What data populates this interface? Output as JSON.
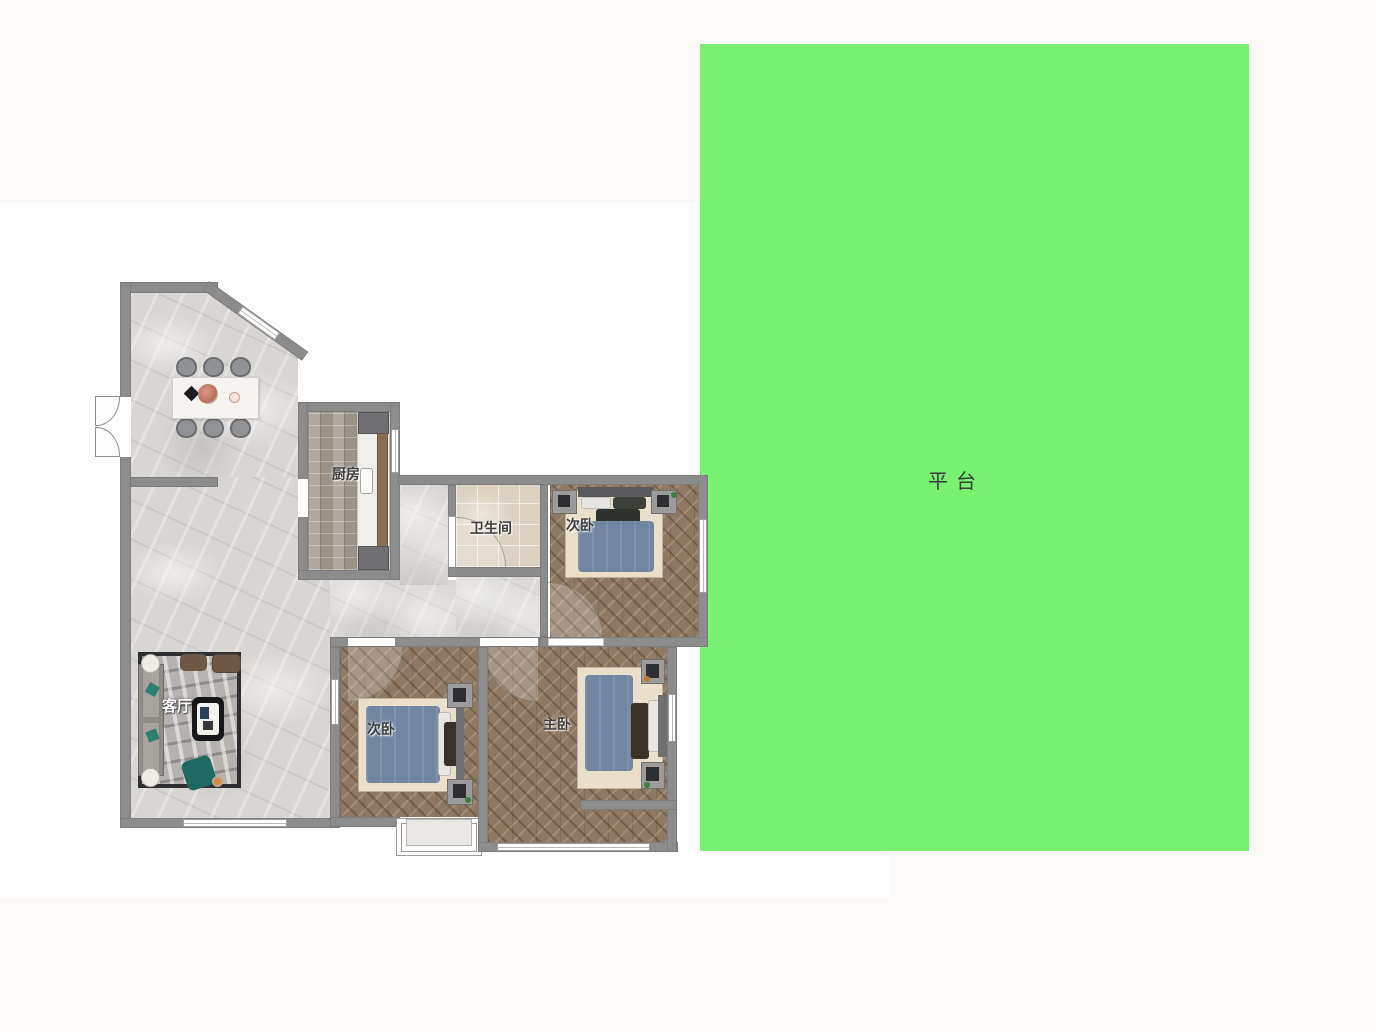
{
  "canvas": {
    "width": 1376,
    "height": 1032
  },
  "rooms": {
    "kitchen": {
      "label": "厨房"
    },
    "bathroom": {
      "label": "卫生间"
    },
    "bedroom_top": {
      "label": "次卧"
    },
    "bedroom_left": {
      "label": "次卧"
    },
    "bedroom_master": {
      "label": "主卧"
    },
    "living": {
      "label": "客厅"
    },
    "platform": {
      "label": "平台"
    }
  },
  "colors": {
    "platform_green": "#78f170",
    "wall_gray": "#8c8c8c",
    "marble_floor": "#d8d6d3",
    "wood_herringbone": "#8e7963",
    "kitchen_parquet": "#a89e94",
    "bath_tile": "#ddd2c1",
    "bed_duvet": "#7285a1",
    "bed_mat": "#e9dfca",
    "rug_gray": "#b5b2af",
    "accent_teal": "#1e6a60",
    "label_dark": "#3e3e3e",
    "label_light": "#ffffff"
  }
}
